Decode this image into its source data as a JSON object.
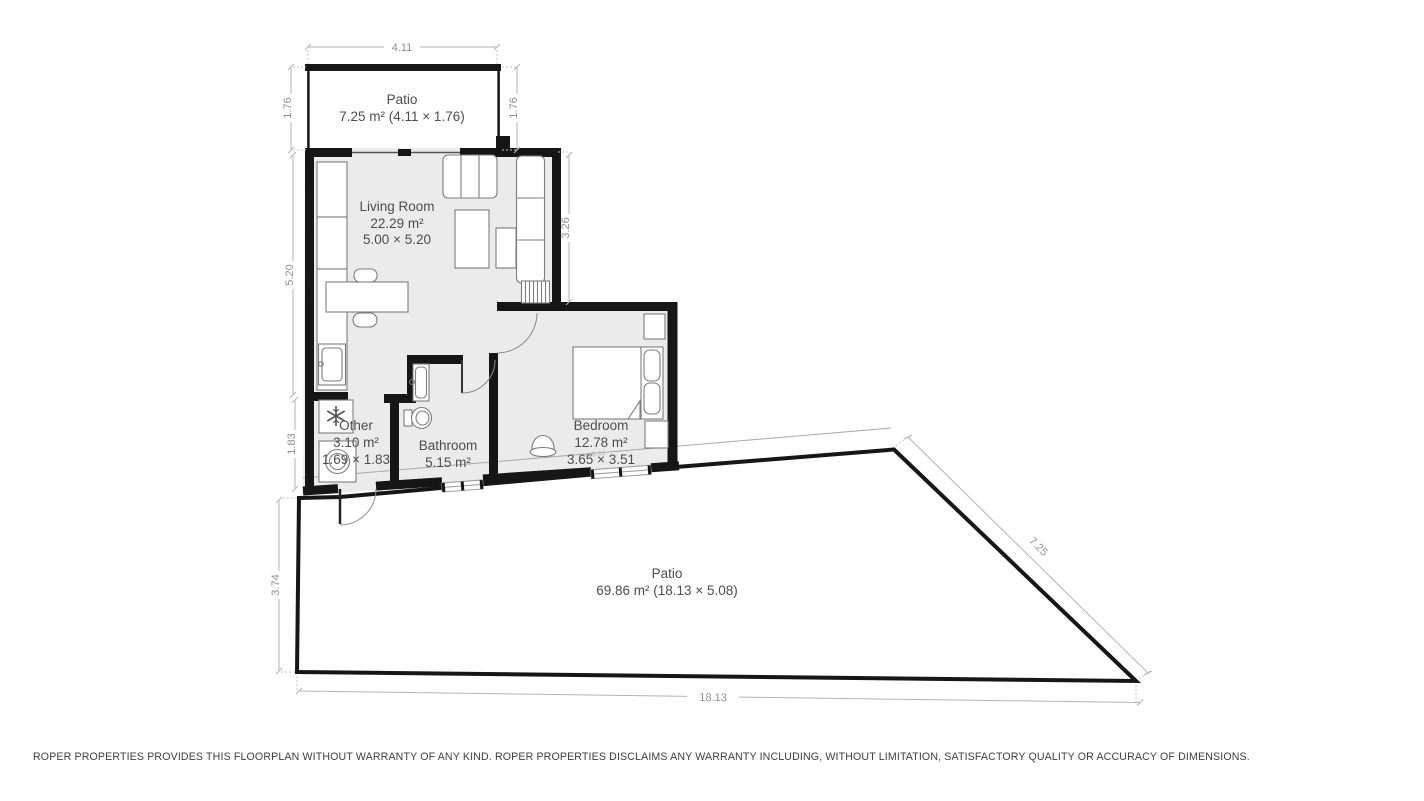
{
  "colors": {
    "wall": "#161616",
    "room_fill": "#ebebeb",
    "patio_fill": "#ffffff",
    "dimension_line": "#b3b3b3",
    "dimension_text": "#8f8f8f",
    "room_label_text": "#4d4d4d"
  },
  "rooms": {
    "patio_top": {
      "name": "Patio",
      "area": "7.25 m² (4.11 × 1.76)"
    },
    "living_room": {
      "name": "Living Room",
      "area": "22.29 m²",
      "dims": "5.00 × 5.20"
    },
    "other": {
      "name": "Other",
      "area": "3.10 m²",
      "dims": "1.69 × 1.83"
    },
    "bathroom": {
      "name": "Bathroom",
      "area": "5.15 m²"
    },
    "bedroom": {
      "name": "Bedroom",
      "area": "12.78 m²",
      "dims": "3.65 × 3.51",
      "annotation": "16.01"
    },
    "patio_bottom": {
      "name": "Patio",
      "area": "69.86 m² (18.13 × 5.08)"
    }
  },
  "dimensions": {
    "patio_top_width": "4.11",
    "patio_top_side_left": "1.76",
    "patio_top_side_right": "1.76",
    "living_room_left": "5.20",
    "living_room_right": "3.26",
    "other_left": "1.83",
    "patio_bottom_left": "3.74",
    "patio_bottom_width": "18.13",
    "patio_bottom_diagonal": "7.25"
  },
  "footer": {
    "disclaimer": "ROPER PROPERTIES PROVIDES THIS FLOORPLAN WITHOUT WARRANTY OF ANY KIND. ROPER PROPERTIES DISCLAIMS ANY WARRANTY INCLUDING, WITHOUT LIMITATION, SATISFACTORY QUALITY OR ACCURACY OF DIMENSIONS."
  }
}
